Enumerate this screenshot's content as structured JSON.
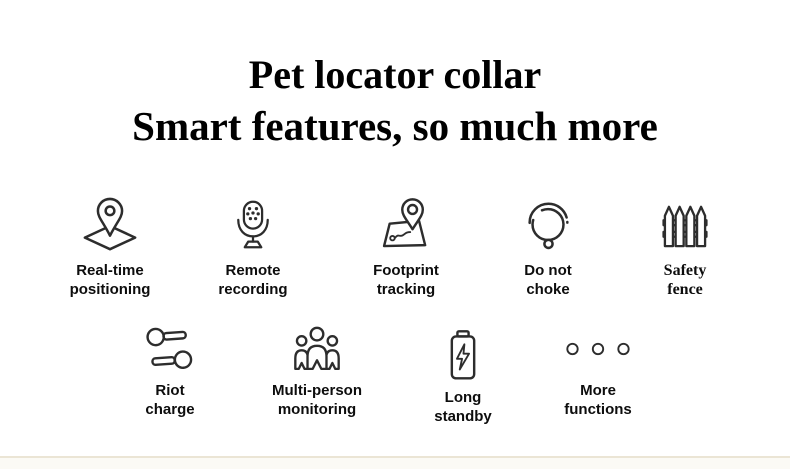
{
  "page": {
    "background_color": "#ffffff",
    "text_color": "#0d0d0d",
    "icon_stroke_color": "#2d2d2d",
    "bottom_strip_color": "#fbfaf5",
    "bottom_strip_line_color": "#ebe5d5"
  },
  "title": {
    "line1": "Pet locator collar",
    "line2": "Smart features, so much more"
  },
  "features": {
    "row1": [
      {
        "icon": "map-pin-icon",
        "line1": "Real-time",
        "line2": "positioning"
      },
      {
        "icon": "microphone-icon",
        "line1": "Remote",
        "line2": "recording"
      },
      {
        "icon": "map-route-icon",
        "line1": "Footprint",
        "line2": "tracking"
      },
      {
        "icon": "collar-icon",
        "line1": "Do not",
        "line2": "choke"
      },
      {
        "icon": "fence-icon",
        "line1": "Safety",
        "line2": "fence"
      }
    ],
    "row2": [
      {
        "icon": "riot-charge-icon",
        "line1": "Riot",
        "line2": "charge"
      },
      {
        "icon": "multi-person-icon",
        "line1": "Multi-person",
        "line2": "monitoring"
      },
      {
        "icon": "battery-icon",
        "line1": "Long",
        "line2": "standby"
      },
      {
        "icon": "ellipsis-icon",
        "line1": "More",
        "line2": "functions"
      }
    ]
  }
}
